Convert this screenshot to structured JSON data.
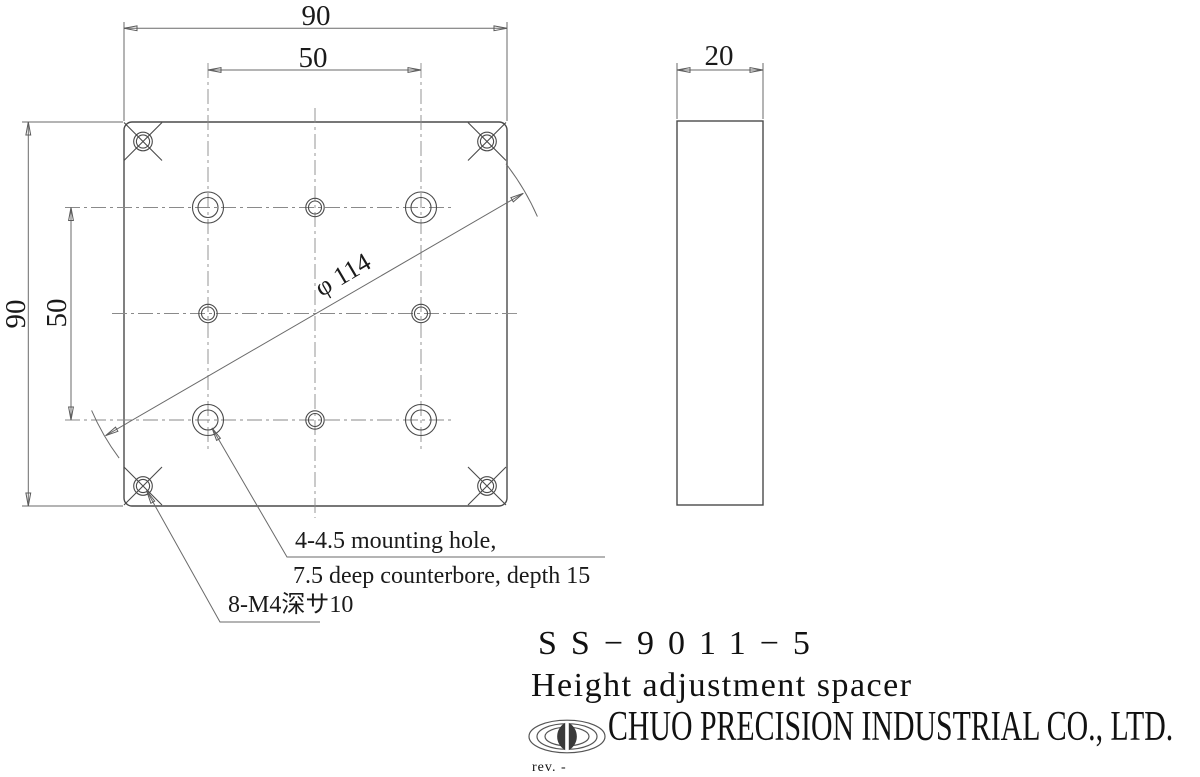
{
  "dimensions": {
    "plate_width": "90",
    "hole_pitch_horizontal": "50",
    "plate_height": "90",
    "hole_pitch_vertical": "50",
    "thickness": "20",
    "bolt_circle_diameter": "φ 114"
  },
  "notes": {
    "mounting_hole_line1": "4-4.5 mounting hole,",
    "mounting_hole_line2": "7.5 deep counterbore, depth 15",
    "tapped_hole": "8-M4深サ10"
  },
  "title_block": {
    "part_number": "SS−9011−5",
    "part_name": "Height adjustment spacer",
    "company": "CHUO PRECISION INDUSTRIAL CO., LTD.",
    "revision": "rev. -",
    "logo": "chuo-precision-ellipse-logo"
  },
  "colors": {
    "background": "#ffffff",
    "object_line": "#4a4a4a",
    "center_line": "#8a8a8a",
    "dimension_line": "#6a6a6a",
    "text": "#1a1a1a"
  }
}
